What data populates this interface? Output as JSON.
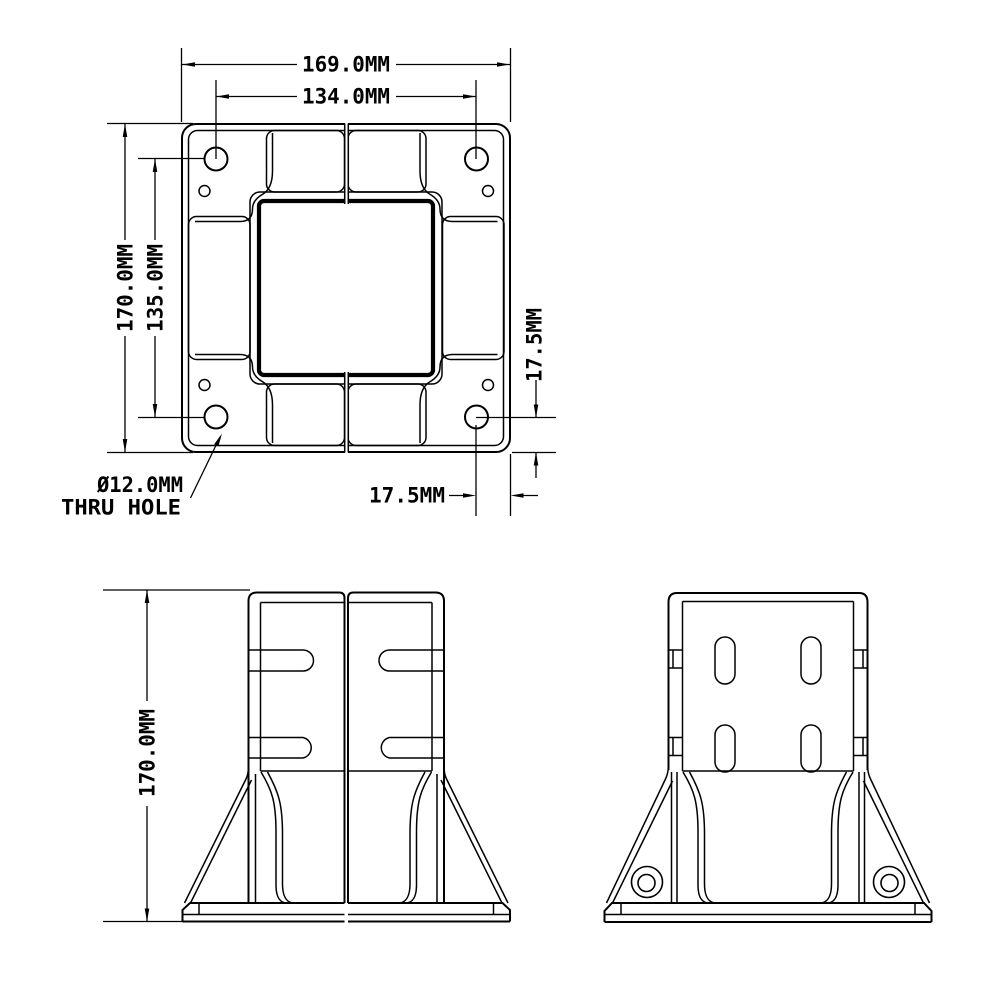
{
  "page": {
    "background": "#ffffff"
  },
  "drawing": {
    "line_color": "#000000",
    "top_view": {
      "dim_overall_width": "169.0MM",
      "dim_hole_spacing_horizontal": "134.0MM",
      "dim_overall_height": "170.0MM",
      "dim_hole_spacing_vertical": "135.0MM",
      "dim_hole_edge_offset_right": "17.5MM",
      "dim_hole_edge_offset_bottom": "17.5MM",
      "callout_line1": "Ø12.0MM",
      "callout_line2": "THRU HOLE"
    },
    "front_view": {
      "dim_overall_height": "170.0MM"
    }
  }
}
